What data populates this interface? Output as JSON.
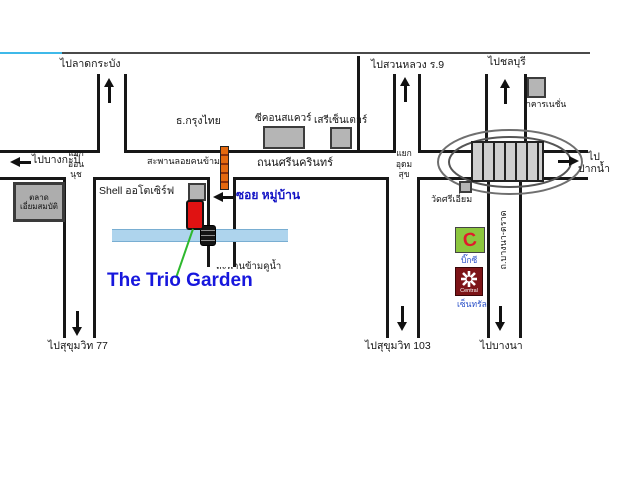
{
  "title": "The Trio Garden location map",
  "labels": {
    "to_lat_krabang": "ไปลาดกระบัง",
    "to_suan_luang": "ไปสวนหลวง ร.9",
    "to_chonburi": "ไปชลบุรี",
    "to_bang_kapi": "ไปบางกะปิ",
    "to_pak_nam_line1": "ไป",
    "to_pak_nam_line2": "ปากน้ำ",
    "to_sukhumvit_77": "ไปสุขุมวิท 77",
    "to_sukhumvit_103": "ไปสุขุมวิท 103",
    "to_bang_na": "ไปบางนา",
    "srinakarin_road": "ถนนศรีนครินทร์",
    "bangna_trat_road": "ถ.บางนา-ตราด",
    "onnut_junction": [
      "แยก",
      "อ่อน",
      "นุช"
    ],
    "udomsuk_junction": [
      "แยก",
      "อุดม",
      "สุข"
    ],
    "krungthai_bank": "ธ.กรุงไทย",
    "seacon_square": "ซีคอนสแควร์",
    "seri_center": "เสรีเซ็นเตอร์",
    "pedestrian_bridge": "สะพานลอยคนข้าม",
    "iam_sombat_market": [
      "ตลาด",
      "เอี่ยมสมบัติ"
    ],
    "shell_station": "Shell ออโตเซิร์ฟ",
    "soi_mu_ban": "ซอย หมู่บ้าน",
    "canal_bridge": "สะพานข้ามคูน้ำ",
    "project_name": "The Trio Garden",
    "wat_sri_iam": "วัดศรีเอี่ยม",
    "nation_building": "อาคารเนชั่น",
    "big_c": "บิ๊กซี",
    "central": "เซ็นทรัล",
    "central_logo_text": "Central",
    "big_c_logo_letter": "C"
  },
  "colors": {
    "project_name_blue": "#1717dd",
    "soi_label_blue": "#1212c4",
    "canal_blue": "#aed4ed",
    "pedestrian_bridge_orange": "#e4690f",
    "shell_marker_red": "#e01212",
    "big_c_green": "#8cc63e",
    "big_c_letter_red": "#e01b2c",
    "central_dark_red": "#7d1417",
    "top_border_cyan": "#3fb9e9",
    "road_line_black": "#171717"
  }
}
